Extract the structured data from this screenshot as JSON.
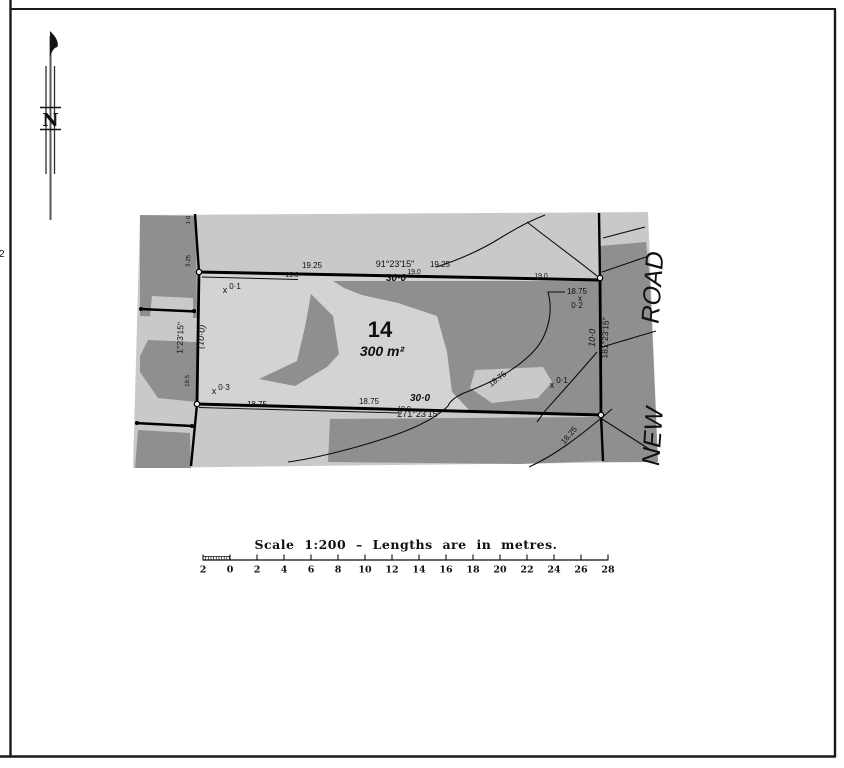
{
  "page": {
    "edge_mark": "2"
  },
  "north_arrow": {
    "letter": "N"
  },
  "plan": {
    "lot_number": "14",
    "lot_area": "300 m²",
    "road_name": "NEW ROAD",
    "boundaries": {
      "north": {
        "bearing": "91°23'15\"",
        "distance": "30·0"
      },
      "south": {
        "bearing": "271°23'15\"",
        "distance": "30·0"
      },
      "west": {
        "bearing": "1°23'15\"",
        "distance": "(10·0)"
      },
      "east": {
        "bearing": "181°23'15\"",
        "distance": "10·0"
      }
    },
    "labels": [
      {
        "n": "contour-label-19-25-a",
        "t": "19.25",
        "x": 312,
        "y": 268,
        "s": 8
      },
      {
        "n": "distance-label-19-0-a",
        "t": "19.0",
        "x": 292,
        "y": 277,
        "s": 7
      },
      {
        "n": "bearing-north",
        "t": "91°23'15\"",
        "x": 395,
        "y": 267,
        "s": 9
      },
      {
        "n": "contour-label-19-25-b",
        "t": "19.25",
        "x": 440,
        "y": 267,
        "s": 8
      },
      {
        "n": "distance-north",
        "t": "30·0",
        "x": 396,
        "y": 281,
        "s": 10,
        "b": 1,
        "i": 1
      },
      {
        "n": "distance-label-19-0-b",
        "t": "19.0",
        "x": 414,
        "y": 274,
        "s": 7
      },
      {
        "n": "distance-label-19-0-c",
        "t": "19.0",
        "x": 541,
        "y": 278,
        "s": 7
      },
      {
        "n": "spot-mark-tl",
        "t": "x",
        "x": 225,
        "y": 293,
        "s": 9
      },
      {
        "n": "spot-level-0-1-tl",
        "t": "0·1",
        "x": 235,
        "y": 289,
        "s": 8
      },
      {
        "n": "contour-label-18-75-leader",
        "t": "18.75",
        "x": 577,
        "y": 294,
        "s": 8
      },
      {
        "n": "spot-mark-tr",
        "t": "x",
        "x": 580,
        "y": 301,
        "s": 8
      },
      {
        "n": "spot-level-0-2",
        "t": "0·2",
        "x": 577,
        "y": 308,
        "s": 8
      },
      {
        "n": "distance-east",
        "t": "10·0",
        "x": 595,
        "y": 338,
        "s": 9,
        "i": 1,
        "rot": -88
      },
      {
        "n": "bearing-east",
        "t": "181°23'15\"",
        "x": 608,
        "y": 338,
        "s": 8.5,
        "rot": -88
      },
      {
        "n": "spot-mark-r",
        "t": "x",
        "x": 552,
        "y": 388,
        "s": 9
      },
      {
        "n": "spot-level-0-1-r",
        "t": "0·1",
        "x": 562,
        "y": 383,
        "s": 8
      },
      {
        "n": "contour-label-18-75-diag",
        "t": "18.75",
        "x": 499,
        "y": 381,
        "s": 8,
        "rot": -38
      },
      {
        "n": "contour-label-18-25-diag",
        "t": "18.25",
        "x": 571,
        "y": 437,
        "s": 8,
        "rot": -50
      },
      {
        "n": "bearing-west",
        "t": "1°23'15\"",
        "x": 183,
        "y": 338,
        "s": 8.5,
        "rot": -88
      },
      {
        "n": "distance-west",
        "t": "(10·0)",
        "x": 204,
        "y": 337,
        "s": 9,
        "i": 1,
        "rot": -85
      },
      {
        "n": "contour-label-18-5",
        "t": "18.5",
        "x": 189,
        "y": 381,
        "s": 6,
        "rot": -88
      },
      {
        "n": "extension-distance-a",
        "t": "1·0",
        "x": 190,
        "y": 220,
        "s": 6,
        "rot": -88
      },
      {
        "n": "extension-distance-b",
        "t": "3·25",
        "x": 190,
        "y": 261,
        "s": 6,
        "rot": -88
      },
      {
        "n": "spot-mark-bl",
        "t": "x",
        "x": 214,
        "y": 394,
        "s": 9
      },
      {
        "n": "spot-level-0-3",
        "t": "0·3",
        "x": 224,
        "y": 390,
        "s": 8
      },
      {
        "n": "distance-label-18-75-a",
        "t": "18.75",
        "x": 257,
        "y": 407,
        "s": 8
      },
      {
        "n": "distance-label-18-75-b",
        "t": "18.75",
        "x": 369,
        "y": 404,
        "s": 8
      },
      {
        "n": "distance-south",
        "t": "30·0",
        "x": 420,
        "y": 401,
        "s": 10,
        "b": 1,
        "i": 1
      },
      {
        "n": "distance-label-19-0-d",
        "t": "19.0",
        "x": 404,
        "y": 411,
        "s": 7
      },
      {
        "n": "bearing-south",
        "t": "271°23'15\"",
        "x": 419,
        "y": 417,
        "s": 9
      },
      {
        "n": "lot-number",
        "t": "14",
        "x": 380,
        "y": 337,
        "s": 22,
        "b": 1
      },
      {
        "n": "lot-area",
        "t": "300 m²",
        "x": 382,
        "y": 356,
        "s": 14,
        "b": 1,
        "i": 1
      },
      {
        "n": "road-name-road",
        "t": "ROAD",
        "x": 661,
        "y": 288,
        "s": 25,
        "i": 1,
        "rot": -86
      },
      {
        "n": "road-name-new",
        "t": "NEW",
        "x": 661,
        "y": 437,
        "s": 25,
        "i": 1,
        "rot": -86
      }
    ]
  },
  "scale_bar": {
    "title": "Scale 1:200 – Lengths are in metres.",
    "tick_labels": [
      "2",
      "0",
      "2",
      "4",
      "6",
      "8",
      "10",
      "12",
      "14",
      "16",
      "18",
      "20",
      "22",
      "24",
      "26",
      "28"
    ]
  },
  "colors": {
    "paper": "#ffffff",
    "map_light": "#c9c9c9",
    "map_lot_light": "#d3d3d3",
    "map_dark": "#8f8f8f",
    "line": "#0d0d0d"
  }
}
